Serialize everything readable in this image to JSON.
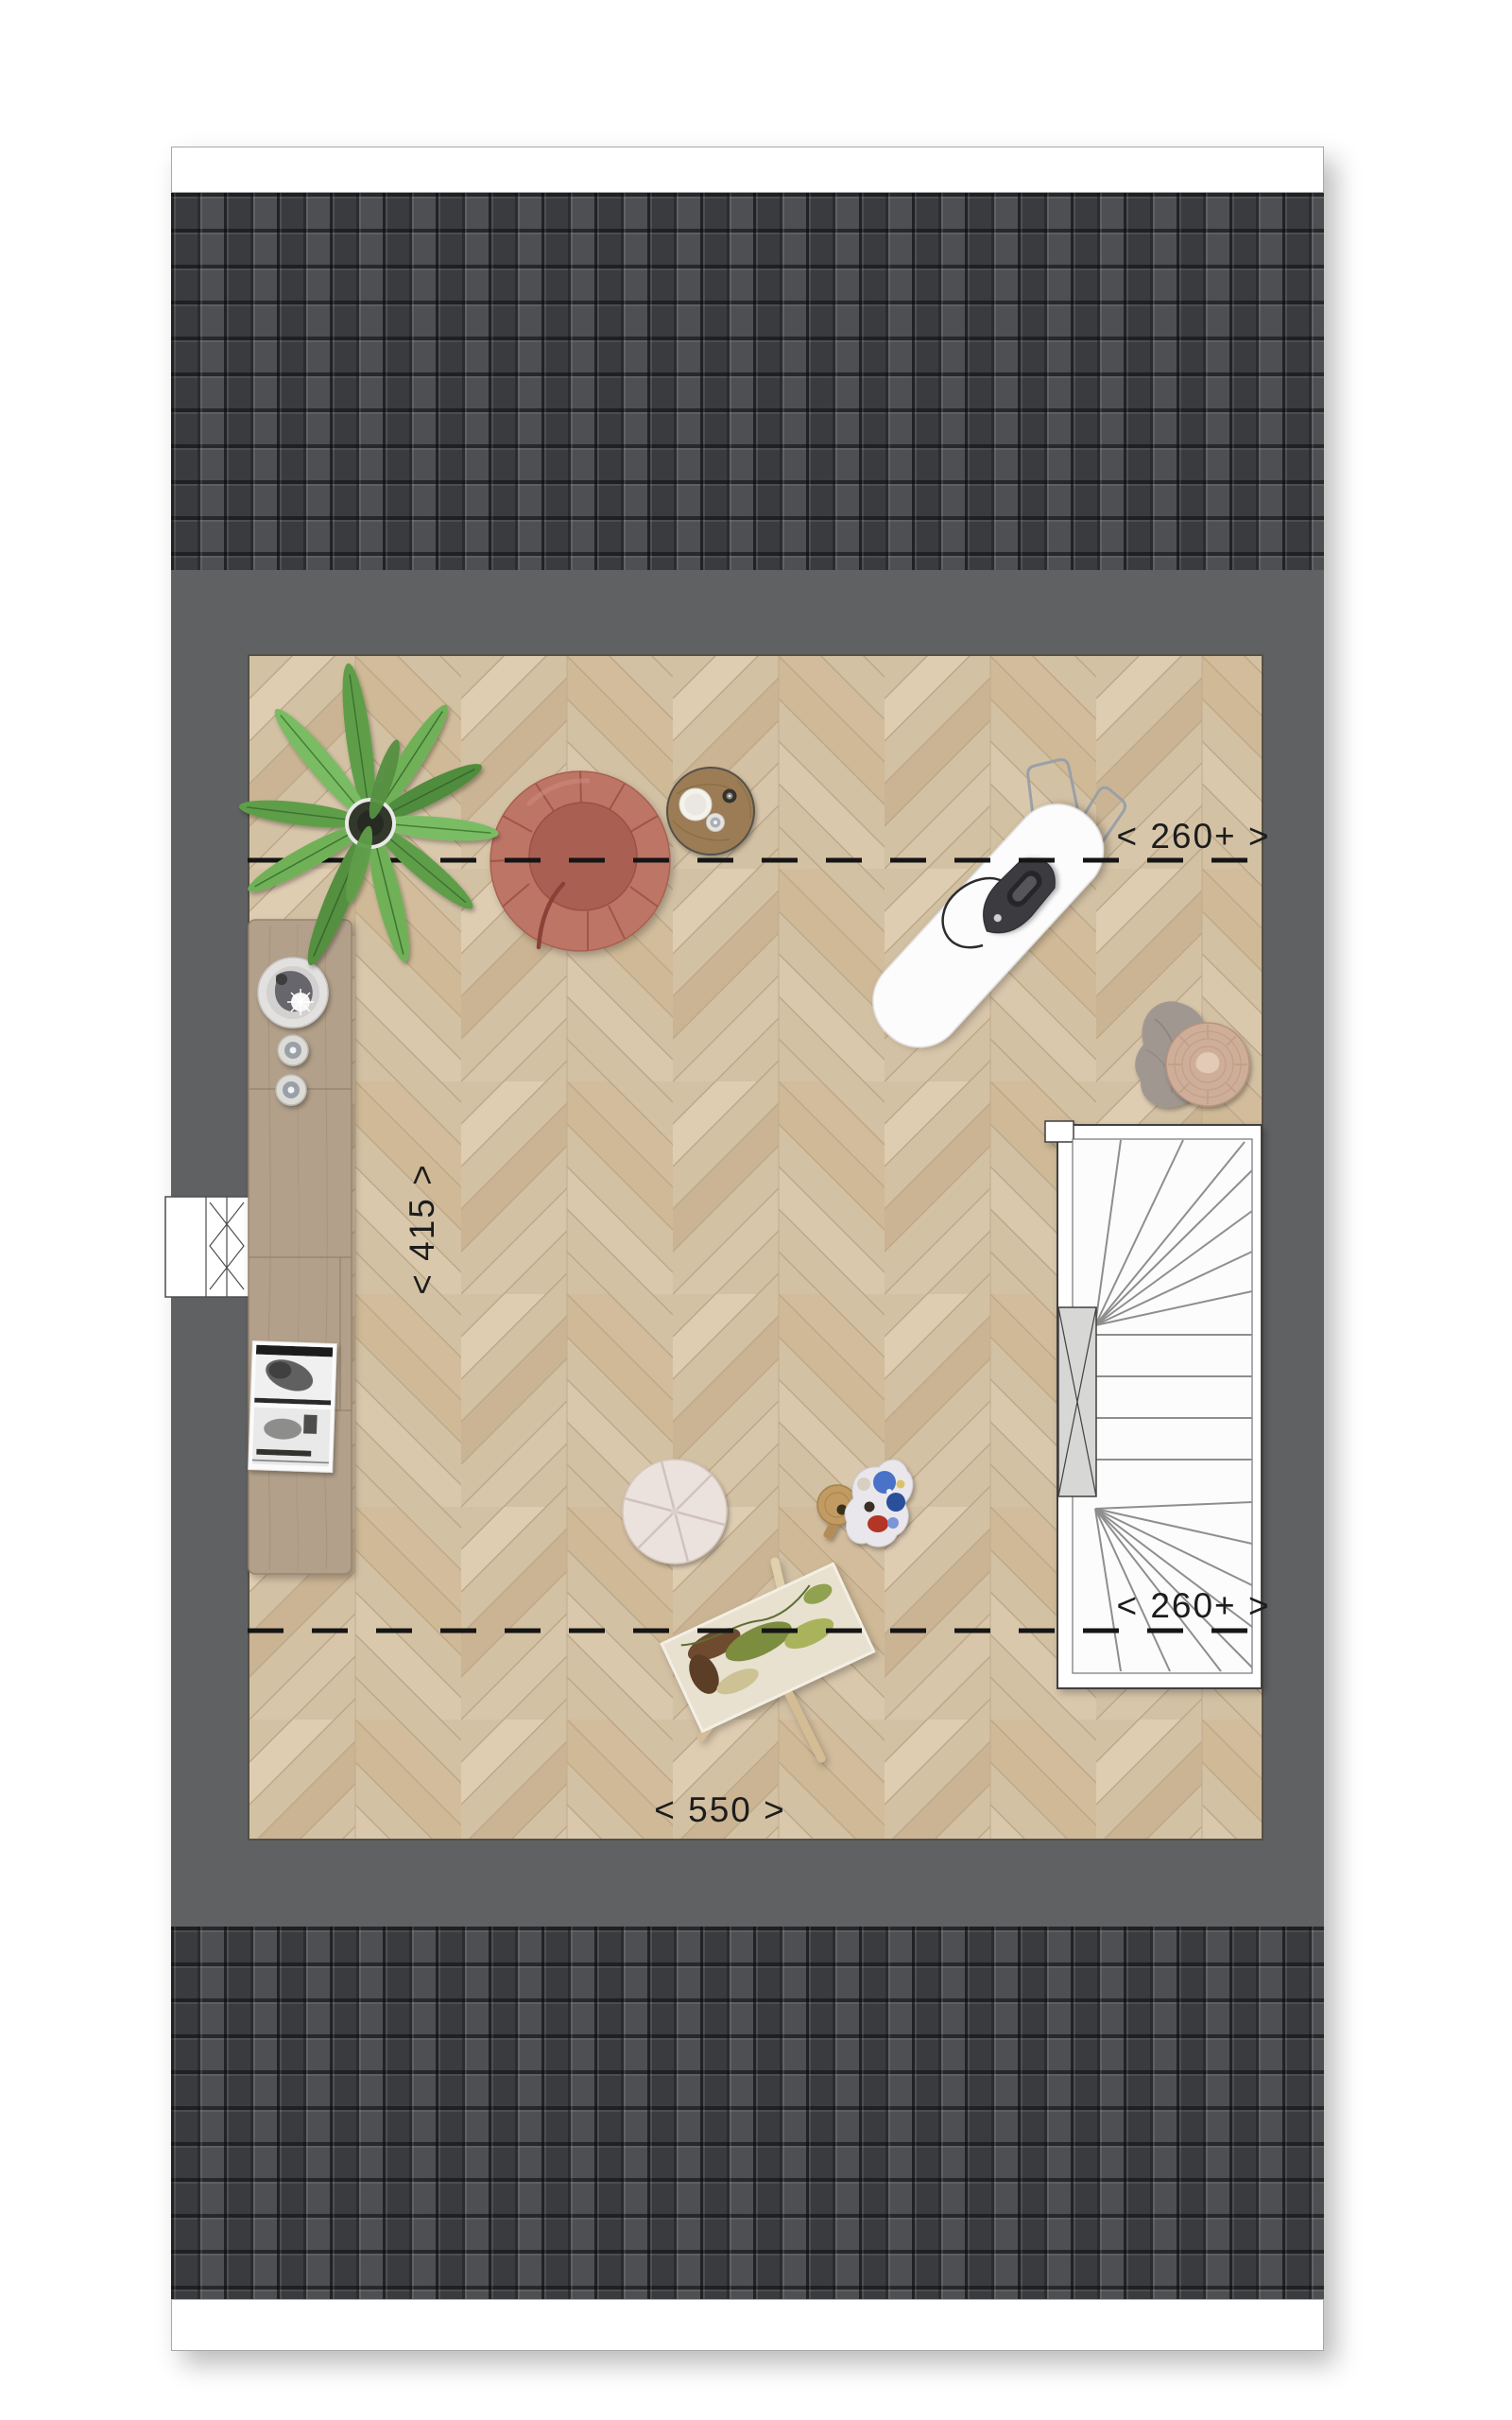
{
  "labels": {
    "dim_width_upper": "< 260+ >",
    "dim_width_lower": "< 260+ >",
    "dim_depth_left": "< 415 >",
    "dim_width_bottom": "< 550 >"
  },
  "palette": {
    "page_bg": "#ffffff",
    "roof_tile": "#44464a",
    "wall_gray": "#5f6163",
    "floor_wood_light": "#dfcdb2",
    "floor_wood_dark": "#cbb493",
    "counter_wood": "#b2a08a",
    "sofa_terracotta": "#bd7466",
    "plant_green": "#5f9e49",
    "pouf_tan": "#cfae99",
    "stair_white": "#ffffff",
    "stair_void_gray": "#d7d7d5",
    "dash_ink": "#151515",
    "label_ink": "#1c1c1c"
  },
  "objects": {
    "plant": "potted-palm",
    "sofa": "round-loveseat",
    "side_table": "round-side-table",
    "ironing_board": "ironing-board-with-iron",
    "counter": "kitchen-sideboard",
    "photos": "framed-photo-prints",
    "window": "casement-window-symbol",
    "rug": "segmented-round-pouf",
    "stool": "painter-stool-with-palette",
    "easel": "easel-with-painting",
    "pouf": "woven-pouf",
    "blanket": "throw-blanket",
    "stairs": "winder-staircase",
    "stair_void": "stair-void-cross"
  }
}
